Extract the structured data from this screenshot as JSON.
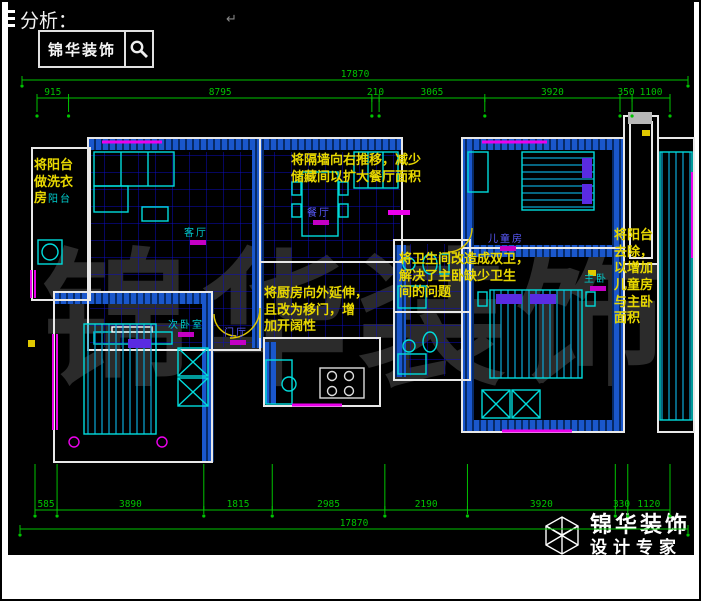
{
  "header": {
    "label": "分析：",
    "paragraph_mark": "↵"
  },
  "brand_box": {
    "name": "锦华装饰"
  },
  "dimensions": {
    "top": {
      "total": "17870",
      "segments": [
        "915",
        "8795",
        "210",
        "3065",
        "3920",
        "350",
        "1100"
      ]
    },
    "bottom": {
      "total": "17870",
      "segments": [
        "585",
        "3890",
        "1815",
        "2985",
        "2190",
        "3920",
        "330",
        "1120"
      ]
    }
  },
  "annotations": {
    "balcony_laundry": "将阳台\n做洗衣\n房",
    "partition_move": "将隔墙向右推移，减少\n储藏间以扩大餐厅面积",
    "kitchen_extend": "将厨房向外延伸，\n且改为移门，增\n加开阔性",
    "bathroom_double": "将卫生间改造成双卫，\n解决了主卧缺少卫生\n间的问题",
    "balcony_remove": "将阳台\n去除，\n以增加\n儿童房\n与主卧\n面积"
  },
  "rooms": {
    "balcony": "阳台",
    "living": "客厅",
    "dining": "餐厅",
    "hall": "门厅",
    "bedroom2": "次卧室",
    "kids": "儿童房",
    "master": "主卧"
  },
  "watermark": "锦华装饰",
  "footer_logo": {
    "brand": "锦华装饰",
    "tagline": "设计专家"
  },
  "colors": {
    "dimension": "#00c300",
    "annotation": "#e8d800",
    "wall_fill": "#1c5cd6",
    "furniture": "#00dcdc",
    "window": "#ec00ec",
    "tile_grid": "#0d0dc0"
  }
}
